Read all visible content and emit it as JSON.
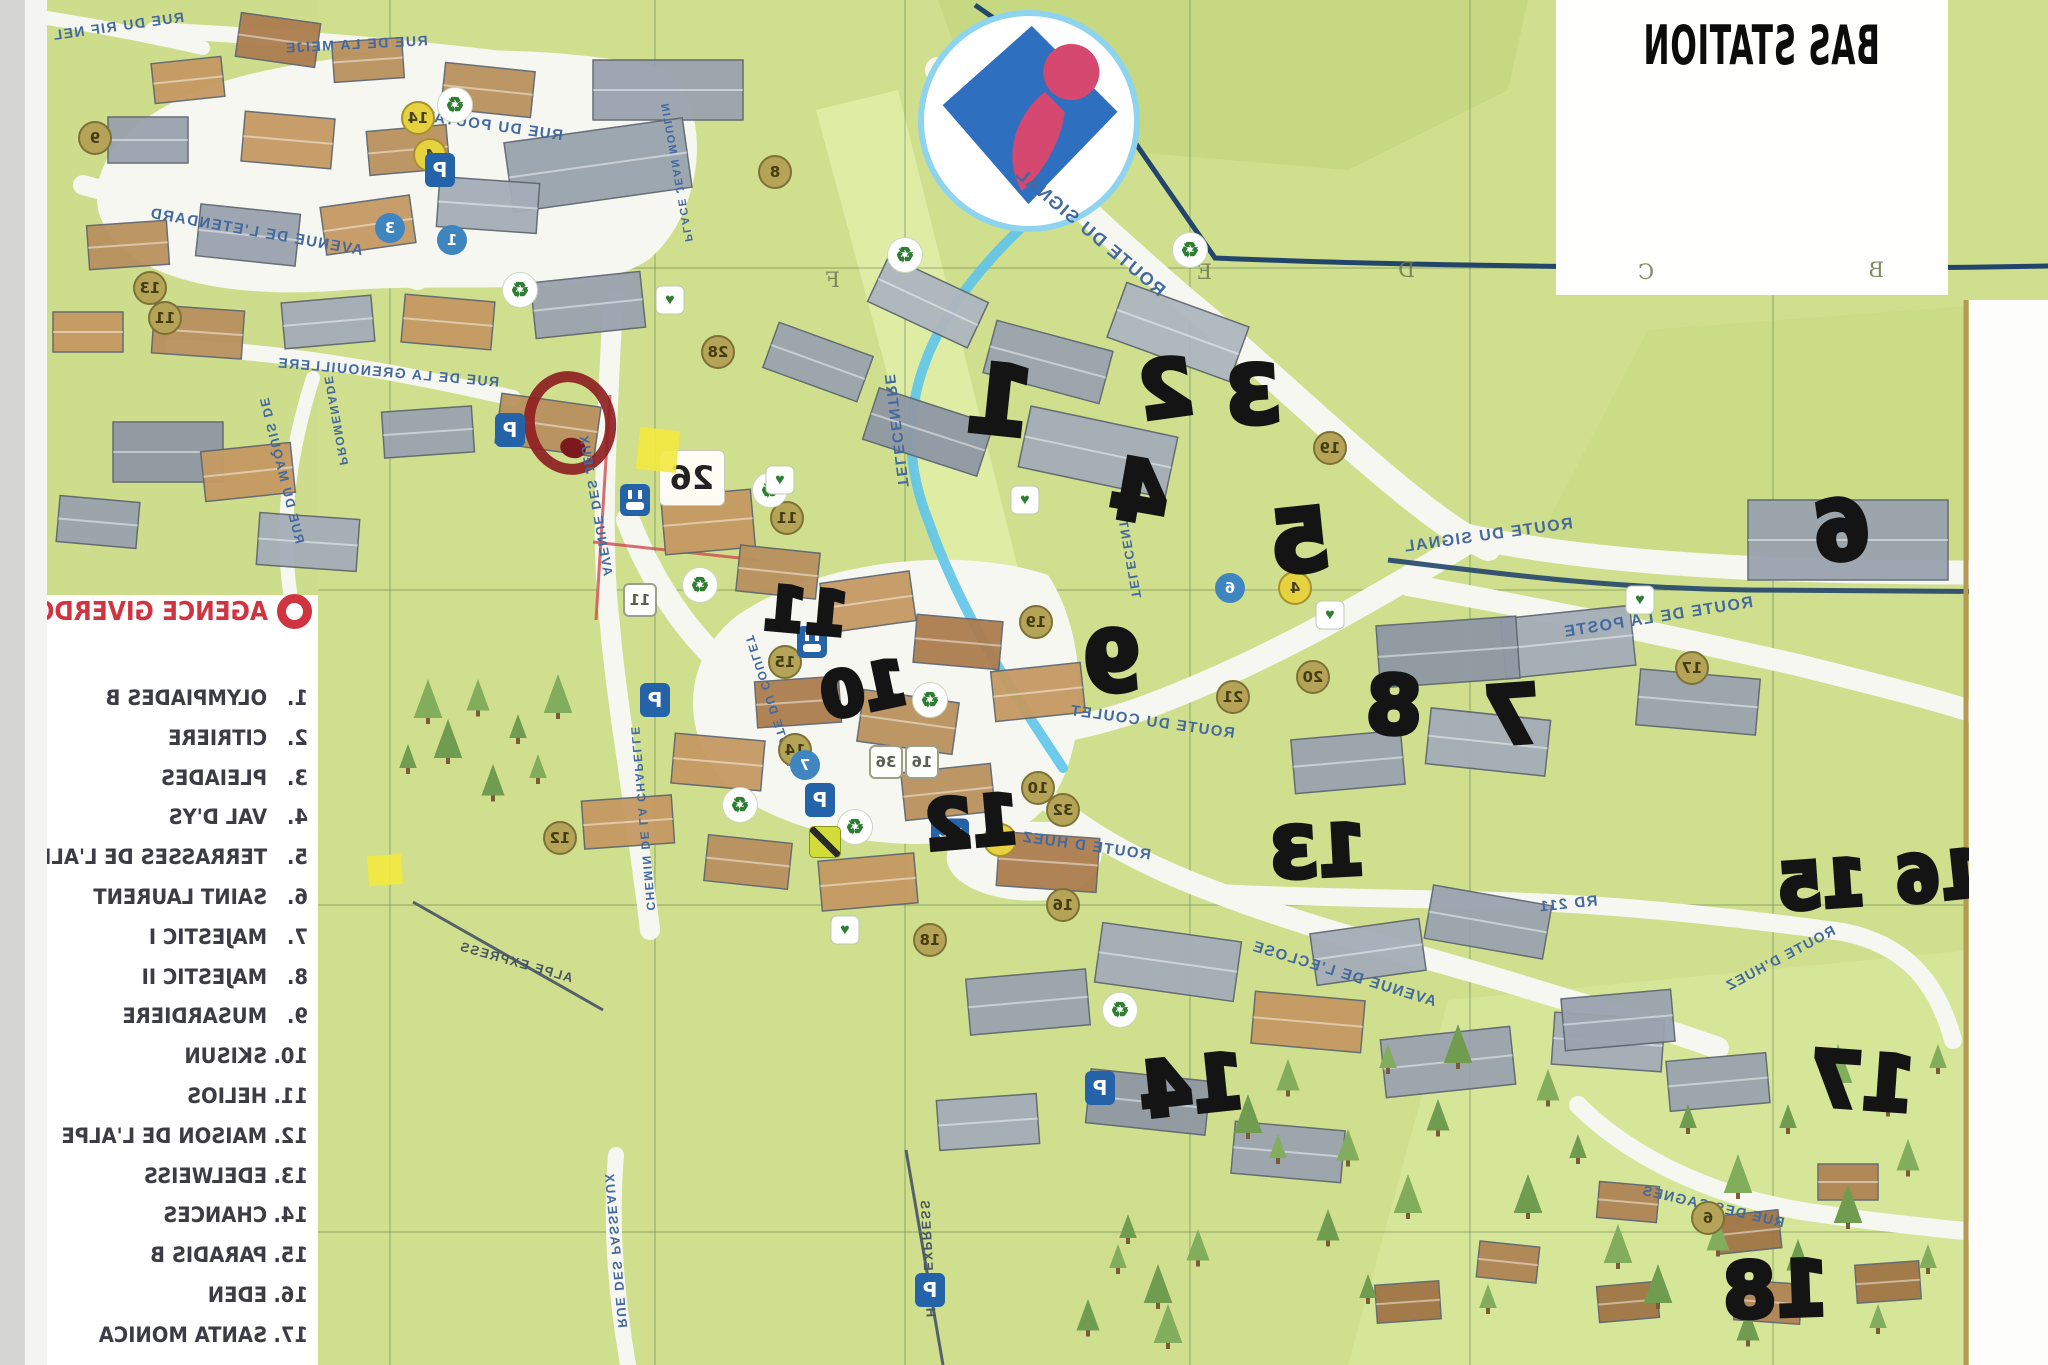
{
  "title": "BAS STATION",
  "legend": {
    "agency": "AGENCE GIVERDON",
    "items": [
      {
        "num": "1.",
        "name": "OLYMPIADES B"
      },
      {
        "num": "2.",
        "name": "CITRIERE"
      },
      {
        "num": "3.",
        "name": "PLEIADES"
      },
      {
        "num": "4.",
        "name": "VAL D'YS"
      },
      {
        "num": "5.",
        "name": "TERRASSES DE L'ALPE"
      },
      {
        "num": "6.",
        "name": "SAINT LAURENT"
      },
      {
        "num": "7.",
        "name": "MAJESTIC I"
      },
      {
        "num": "8.",
        "name": "MAJESTIC II"
      },
      {
        "num": "9.",
        "name": "MUSARDIERE"
      },
      {
        "num": "10.",
        "name": "SKISUN"
      },
      {
        "num": "11.",
        "name": "HELIOS"
      },
      {
        "num": "12.",
        "name": "MAISON DE L'ALPE"
      },
      {
        "num": "13.",
        "name": "EDELWEISS"
      },
      {
        "num": "14.",
        "name": "CHANCES"
      },
      {
        "num": "15.",
        "name": "PARADIS B"
      },
      {
        "num": "16.",
        "name": "EDEN"
      },
      {
        "num": "17.",
        "name": "SANTA MONICA"
      },
      {
        "num": "18.",
        "name": ""
      }
    ]
  },
  "grid_letters": [
    {
      "label": "B",
      "x": 164,
      "y": 258
    },
    {
      "label": "C",
      "x": 394,
      "y": 260
    },
    {
      "label": "D",
      "x": 633,
      "y": 258
    },
    {
      "label": "E",
      "x": 836,
      "y": 260
    },
    {
      "label": "F",
      "x": 1208,
      "y": 268
    }
  ],
  "handwritten_markers": [
    {
      "label": "1",
      "x": 1048,
      "y": 402,
      "size": 95,
      "rot": -6
    },
    {
      "label": "2",
      "x": 882,
      "y": 390,
      "size": 78,
      "rot": 8
    },
    {
      "label": "3",
      "x": 795,
      "y": 396,
      "size": 80,
      "rot": 3
    },
    {
      "label": "4",
      "x": 908,
      "y": 492,
      "size": 84,
      "rot": -10
    },
    {
      "label": "5",
      "x": 748,
      "y": 542,
      "size": 86,
      "rot": 6
    },
    {
      "label": "6",
      "x": 206,
      "y": 532,
      "size": 82,
      "rot": 8
    },
    {
      "label": "7",
      "x": 536,
      "y": 716,
      "size": 80,
      "rot": 4
    },
    {
      "label": "8",
      "x": 654,
      "y": 706,
      "size": 80,
      "rot": -2
    },
    {
      "label": "9",
      "x": 936,
      "y": 662,
      "size": 84,
      "rot": 5
    },
    {
      "label": "10",
      "x": 1184,
      "y": 690,
      "size": 62,
      "rot": 12
    },
    {
      "label": "11",
      "x": 1242,
      "y": 612,
      "size": 60,
      "rot": -5
    },
    {
      "label": "12",
      "x": 1076,
      "y": 824,
      "size": 68,
      "rot": 5
    },
    {
      "label": "13",
      "x": 730,
      "y": 852,
      "size": 70,
      "rot": 3
    },
    {
      "label": "14",
      "x": 856,
      "y": 1086,
      "size": 76,
      "rot": 6
    },
    {
      "label": "15",
      "x": 226,
      "y": 886,
      "size": 64,
      "rot": 4
    },
    {
      "label": "16",
      "x": 108,
      "y": 878,
      "size": 64,
      "rot": 6
    },
    {
      "label": "17",
      "x": 186,
      "y": 1082,
      "size": 76,
      "rot": -4
    },
    {
      "label": "18",
      "x": 272,
      "y": 1290,
      "size": 76,
      "rot": 2
    }
  ],
  "road_labels": [
    {
      "label": "ROUTE DU SIGNAL",
      "x": 958,
      "y": 232,
      "rot": -40,
      "size": 18
    },
    {
      "label": "ROUTE DU SIGNAL",
      "x": 560,
      "y": 536,
      "rot": 8,
      "size": 16
    },
    {
      "label": "ROUTE DE LA POSTE",
      "x": 390,
      "y": 618,
      "rot": 9,
      "size": 16
    },
    {
      "label": "ROUTE DU COULET",
      "x": 896,
      "y": 722,
      "rot": -8,
      "size": 15
    },
    {
      "label": "ROUTE DU COULET",
      "x": 1278,
      "y": 700,
      "rot": -72,
      "size": 12
    },
    {
      "label": "TELECENTRE",
      "x": 1152,
      "y": 430,
      "rot": -83,
      "size": 15
    },
    {
      "label": "TELECENTRE",
      "x": 920,
      "y": 548,
      "rot": -80,
      "size": 13
    },
    {
      "label": "AVENUE DE L'ETENDARD",
      "x": 1792,
      "y": 232,
      "rot": -10,
      "size": 15
    },
    {
      "label": "RUE DU POUTAT",
      "x": 1555,
      "y": 126,
      "rot": -8,
      "size": 15
    },
    {
      "label": "RUE DE LA MEIJE",
      "x": 1692,
      "y": 44,
      "rot": 3,
      "size": 14
    },
    {
      "label": "RUE DU RIF NEL",
      "x": 1930,
      "y": 26,
      "rot": 8,
      "size": 14
    },
    {
      "label": "RUE DE LA GRENOUILLERE",
      "x": 1660,
      "y": 372,
      "rot": -5,
      "size": 14
    },
    {
      "label": "PROMENADE",
      "x": 1712,
      "y": 420,
      "rot": -80,
      "size": 12
    },
    {
      "label": "RUE DU MAQUIS DE",
      "x": 1766,
      "y": 470,
      "rot": -76,
      "size": 13
    },
    {
      "label": "AVENUE DES JEUX",
      "x": 1452,
      "y": 505,
      "rot": -80,
      "size": 13
    },
    {
      "label": "PLACE JEAN MOULIN",
      "x": 1372,
      "y": 172,
      "rot": -80,
      "size": 11
    },
    {
      "label": "ROUTE D HUEZ",
      "x": 962,
      "y": 846,
      "rot": -8,
      "size": 15
    },
    {
      "label": "AVENUE DE L'ECLOSE",
      "x": 704,
      "y": 974,
      "rot": -17,
      "size": 15
    },
    {
      "label": "RD 211",
      "x": 480,
      "y": 904,
      "rot": 6,
      "size": 15
    },
    {
      "label": "ROUTE D'HUEZ",
      "x": 268,
      "y": 958,
      "rot": 28,
      "size": 14
    },
    {
      "label": "RUE DES SAGNES",
      "x": 335,
      "y": 1206,
      "rot": -13,
      "size": 14
    },
    {
      "label": "RUE DES PASSEAUX",
      "x": 1432,
      "y": 1250,
      "rot": -85,
      "size": 13
    },
    {
      "label": "CHEMIN DE LA CHAPELLE",
      "x": 1405,
      "y": 818,
      "rot": -85,
      "size": 12
    },
    {
      "label": "HUEZ EXPRESS",
      "x": 1120,
      "y": 1258,
      "rot": -87,
      "size": 13,
      "kind": "lift"
    },
    {
      "label": "ALPE EXPRESS",
      "x": 1532,
      "y": 962,
      "rot": -16,
      "size": 13,
      "kind": "lift"
    }
  ],
  "printed_badges": [
    {
      "label": "19",
      "x": 718,
      "y": 448,
      "kind": "khaki"
    },
    {
      "label": "19",
      "x": 1012,
      "y": 622,
      "kind": "khaki"
    },
    {
      "label": "20",
      "x": 735,
      "y": 677,
      "kind": "khaki"
    },
    {
      "label": "21",
      "x": 815,
      "y": 697,
      "kind": "khaki"
    },
    {
      "label": "17",
      "x": 356,
      "y": 668,
      "kind": "khaki"
    },
    {
      "label": "28",
      "x": 1330,
      "y": 352,
      "kind": "khaki"
    },
    {
      "label": "11",
      "x": 1261,
      "y": 518,
      "kind": "khaki"
    },
    {
      "label": "11",
      "x": 1408,
      "y": 600,
      "kind": "white"
    },
    {
      "label": "15",
      "x": 1263,
      "y": 662,
      "kind": "khaki"
    },
    {
      "label": "14",
      "x": 1253,
      "y": 750,
      "kind": "khaki"
    },
    {
      "label": "12",
      "x": 1488,
      "y": 838,
      "kind": "khaki"
    },
    {
      "label": "10",
      "x": 1010,
      "y": 788,
      "kind": "khaki"
    },
    {
      "label": "32",
      "x": 985,
      "y": 810,
      "kind": "khaki"
    },
    {
      "label": "16",
      "x": 985,
      "y": 905,
      "kind": "khaki"
    },
    {
      "label": "18",
      "x": 1118,
      "y": 940,
      "kind": "khaki"
    },
    {
      "label": "8",
      "x": 1273,
      "y": 172,
      "kind": "khaki"
    },
    {
      "label": "13",
      "x": 1898,
      "y": 288,
      "kind": "khaki"
    },
    {
      "label": "11",
      "x": 1883,
      "y": 318,
      "kind": "khaki"
    },
    {
      "label": "9",
      "x": 1953,
      "y": 138,
      "kind": "khaki"
    },
    {
      "label": "6",
      "x": 818,
      "y": 588,
      "kind": "blue"
    },
    {
      "label": "4",
      "x": 753,
      "y": 588,
      "kind": "yellow"
    },
    {
      "label": "3",
      "x": 1658,
      "y": 228,
      "kind": "blue"
    },
    {
      "label": "1",
      "x": 1596,
      "y": 240,
      "kind": "blue"
    },
    {
      "label": "7",
      "x": 1243,
      "y": 765,
      "kind": "blue"
    },
    {
      "label": "2",
      "x": 1048,
      "y": 840,
      "kind": "yellow"
    },
    {
      "label": "36",
      "x": 1162,
      "y": 762,
      "kind": "white"
    },
    {
      "label": "16",
      "x": 1126,
      "y": 762,
      "kind": "white"
    },
    {
      "label": "14",
      "x": 1630,
      "y": 118,
      "kind": "yellow"
    },
    {
      "label": "4",
      "x": 1618,
      "y": 155,
      "kind": "yellow"
    },
    {
      "label": "6",
      "x": 340,
      "y": 1218,
      "kind": "khaki"
    },
    {
      "label": "26",
      "x": 1356,
      "y": 478,
      "kind": "box"
    }
  ],
  "amenity_icons": [
    {
      "type": "recycle",
      "x": 1593,
      "y": 105
    },
    {
      "type": "recycle",
      "x": 1528,
      "y": 290
    },
    {
      "type": "recycle",
      "x": 1143,
      "y": 255
    },
    {
      "type": "recycle",
      "x": 1278,
      "y": 490
    },
    {
      "type": "recycle",
      "x": 1348,
      "y": 585
    },
    {
      "type": "recycle",
      "x": 1308,
      "y": 805
    },
    {
      "type": "recycle",
      "x": 1118,
      "y": 700
    },
    {
      "type": "recycle",
      "x": 858,
      "y": 250
    },
    {
      "type": "recycle",
      "x": 1193,
      "y": 827
    },
    {
      "type": "recycle",
      "x": 928,
      "y": 1010
    },
    {
      "type": "parking",
      "x": 1608,
      "y": 170
    },
    {
      "type": "parking",
      "x": 1538,
      "y": 430
    },
    {
      "type": "parking",
      "x": 1228,
      "y": 800
    },
    {
      "type": "parking",
      "x": 1118,
      "y": 1290
    },
    {
      "type": "parking",
      "x": 948,
      "y": 1088
    },
    {
      "type": "parking",
      "x": 1393,
      "y": 700
    },
    {
      "type": "plug",
      "x": 1413,
      "y": 500
    },
    {
      "type": "plug",
      "x": 1236,
      "y": 642
    },
    {
      "type": "heart",
      "x": 1378,
      "y": 300
    },
    {
      "type": "heart",
      "x": 1268,
      "y": 480
    },
    {
      "type": "heart",
      "x": 1023,
      "y": 500
    },
    {
      "type": "heart",
      "x": 718,
      "y": 615
    },
    {
      "type": "heart",
      "x": 408,
      "y": 600
    },
    {
      "type": "heart",
      "x": 1203,
      "y": 930
    },
    {
      "type": "wc",
      "x": 1098,
      "y": 832
    },
    {
      "type": "sign",
      "x": 1223,
      "y": 842
    }
  ],
  "colors": {
    "map_green": "#cfdf8d",
    "road_white": "#f6f7f1",
    "navy_line": "#24456b",
    "light_blue_line": "#5ec4ea",
    "legend_red": "#cf3440",
    "marker_black": "#141414",
    "khaki_badge": "#b5a457"
  }
}
